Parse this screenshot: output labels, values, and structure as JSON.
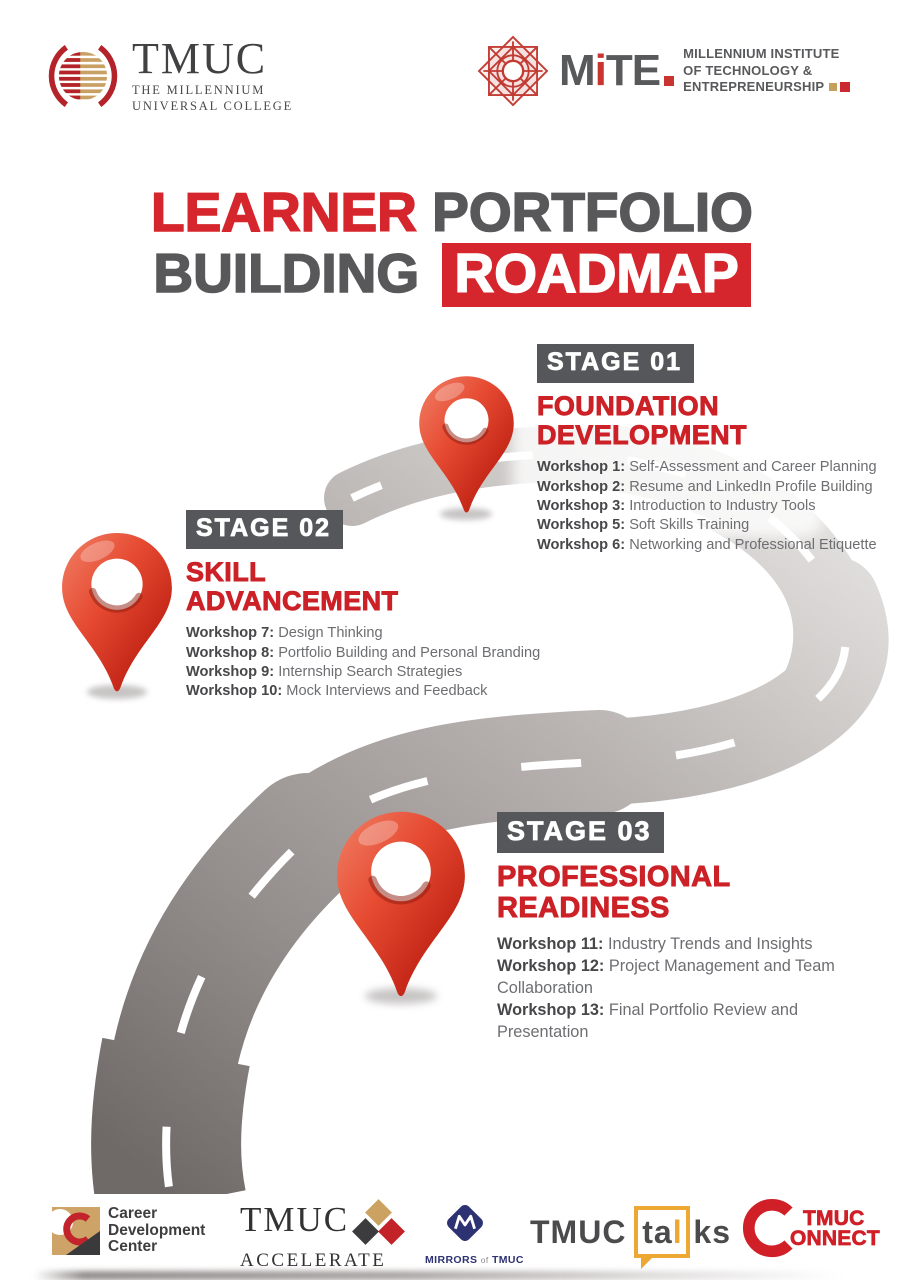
{
  "colors": {
    "brand_red": "#d6262d",
    "heading_red": "#cb2127",
    "dark_gray": "#58595b",
    "text_gray": "#6d6e71",
    "road_light": "#e0dedc",
    "road_dark": "#6f6967",
    "talks_orange": "#eda733",
    "mirrors_navy": "#2d3272",
    "gold": "#c9a063"
  },
  "header": {
    "tmuc": {
      "wordmark": "TMUC",
      "sub1": "THE MILLENNIUM",
      "sub2": "UNIVERSAL COLLEGE"
    },
    "mite": {
      "m": "M",
      "i": "i",
      "t": "T",
      "e": "E",
      "line1": "MILLENNIUM INSTITUTE",
      "line2": "OF TECHNOLOGY &",
      "line3": "ENTREPRENEURSHIP"
    }
  },
  "title": {
    "word1": "LEARNER",
    "word2": "PORTFOLIO",
    "word3": "BUILDING",
    "word4": "ROADMAP"
  },
  "stages": [
    {
      "badge": "STAGE 01",
      "heading1": "FOUNDATION",
      "heading2": "DEVELOPMENT",
      "workshops": [
        {
          "label": "Workshop 1:",
          "desc": "Self-Assessment and Career Planning"
        },
        {
          "label": "Workshop 2:",
          "desc": "Resume and LinkedIn Profile Building"
        },
        {
          "label": "Workshop 3:",
          "desc": "Introduction to Industry Tools"
        },
        {
          "label": "Workshop 5:",
          "desc": "Soft Skills Training"
        },
        {
          "label": "Workshop 6:",
          "desc": "Networking and Professional Etiquette"
        }
      ]
    },
    {
      "badge": "STAGE 02",
      "heading1": "SKILL",
      "heading2": "ADVANCEMENT",
      "workshops": [
        {
          "label": "Workshop 7:",
          "desc": "Design Thinking"
        },
        {
          "label": "Workshop 8:",
          "desc": "Portfolio Building and Personal Branding"
        },
        {
          "label": "Workshop 9:",
          "desc": "Internship Search Strategies"
        },
        {
          "label": "Workshop 10:",
          "desc": "Mock Interviews and Feedback"
        }
      ]
    },
    {
      "badge": "STAGE 03",
      "heading1": "PROFESSIONAL",
      "heading2": "READINESS",
      "workshops": [
        {
          "label": "Workshop 11:",
          "desc": "Industry Trends and Insights"
        },
        {
          "label": "Workshop 12:",
          "desc": "Project Management and Team Collaboration"
        },
        {
          "label": "Workshop 13:",
          "desc": "Final Portfolio Review and Presentation"
        }
      ]
    }
  ],
  "footer": {
    "cdc": {
      "line1": "Career",
      "line2": "Development",
      "line3": "Center"
    },
    "accelerate": {
      "top": "TMUC",
      "bottom": "ACCELERATE"
    },
    "mirrors": {
      "word1": "MIRRORS",
      "word2": "of",
      "word3": "TMUC"
    },
    "talks": {
      "prefix": "TMUC",
      "bubble": "ta",
      "bar": "l",
      "suffix": "ks"
    },
    "connect": {
      "line1": "TMUC",
      "line2": "ONNECT"
    }
  }
}
